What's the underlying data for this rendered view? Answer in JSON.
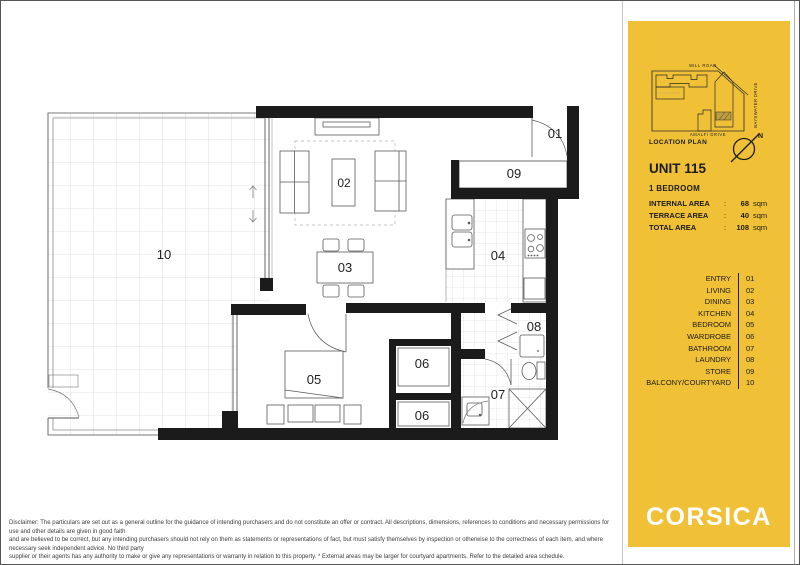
{
  "sidebar": {
    "location": {
      "title": "LOCATION PLAN",
      "roads": {
        "top": "MILL ROAD",
        "bottom": "AMALFI DRIVE",
        "right": "BAYSWATER DRIVE"
      },
      "north_label": "N"
    },
    "unit": {
      "title": "UNIT 115",
      "subtitle": "1 BEDROOM",
      "areas": [
        {
          "label": "INTERNAL AREA",
          "colon": ":",
          "value": "68",
          "unit": "sqm"
        },
        {
          "label": "TERRACE AREA",
          "colon": ":",
          "value": "40",
          "unit": "sqm"
        },
        {
          "label": "TOTAL AREA",
          "colon": ":",
          "value": "108",
          "unit": "sqm"
        }
      ]
    },
    "legend": {
      "items": [
        {
          "name": "ENTRY",
          "code": "01"
        },
        {
          "name": "LIVING",
          "code": "02"
        },
        {
          "name": "DINING",
          "code": "03"
        },
        {
          "name": "KITCHEN",
          "code": "04"
        },
        {
          "name": "BEDROOM",
          "code": "05"
        },
        {
          "name": "WARDROBE",
          "code": "06"
        },
        {
          "name": "BATHROOM",
          "code": "07"
        },
        {
          "name": "LAUNDRY",
          "code": "08"
        },
        {
          "name": "STORE",
          "code": "09"
        },
        {
          "name": "BALCONY/COURTYARD",
          "code": "10"
        }
      ]
    },
    "brand": {
      "logo_text": "CORSICA"
    }
  },
  "plan": {
    "labels": {
      "entry": "01",
      "living": "02",
      "dining": "03",
      "kitchen": "04",
      "bedroom": "05",
      "wardrobe": "06",
      "bathroom": "07",
      "laundry": "08",
      "store": "09",
      "balcony": "10"
    }
  },
  "disclaimer": {
    "line1": "Disclaimer: The particulars are set out as a general outline for the guidance of intending purchasers and do not constitute an offer or contract. All descriptions, dimensions, references to conditions and necessary permissions for use and other details are given in good faith",
    "line2": "and are believed to be correct, but any intending purchasers should not rely on them as statements or representations of fact, but must satisfy themselves by inspection or otherwise to the correctness of each item, and where necessary seek independent advice. No third party",
    "line3": "supplier or their agents has any authority to make or give any representations or warranty in relation to this property.   * External areas may be larger for courtyard apartments. Refer to the detailed area schedule."
  },
  "colors": {
    "brand_yellow": "#F0C137",
    "wall_black": "#1b1b1b"
  }
}
